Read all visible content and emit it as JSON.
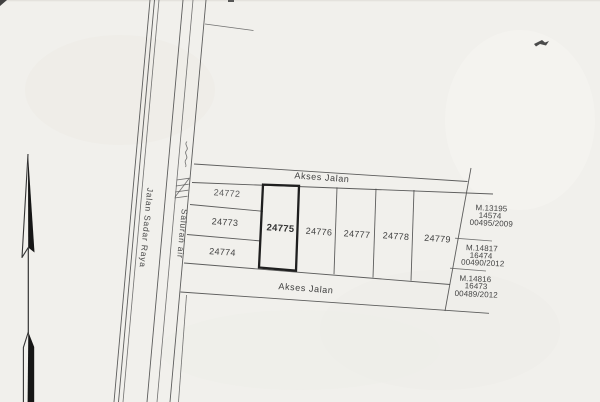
{
  "roads": {
    "access_road_top": "Akses Jalan",
    "access_road_bottom": "Akses Jalan",
    "main_street": "Jalan Sadar Raya",
    "drainage_channel": "Saluran air"
  },
  "parcels": [
    {
      "number": "24772",
      "highlighted": false
    },
    {
      "number": "24773",
      "highlighted": false
    },
    {
      "number": "24774",
      "highlighted": false
    },
    {
      "number": "24775",
      "highlighted": true
    },
    {
      "number": "24776",
      "highlighted": false
    },
    {
      "number": "24777",
      "highlighted": false
    },
    {
      "number": "24778",
      "highlighted": false
    },
    {
      "number": "24779",
      "highlighted": false
    }
  ],
  "certificates": [
    {
      "line1": "M.13195",
      "line2": "14574",
      "line3": "00495/2009"
    },
    {
      "line1": "M.14817",
      "line2": "16474",
      "line3": "00490/2012"
    },
    {
      "line1": "M.14816",
      "line2": "16473",
      "line3": "00489/2012"
    }
  ],
  "icons": {
    "north_arrow": "north-arrow"
  },
  "colors": {
    "paper": "#f1f0ec",
    "ink": "#3f3f3f",
    "highlight_border": "#1f1f1f"
  }
}
